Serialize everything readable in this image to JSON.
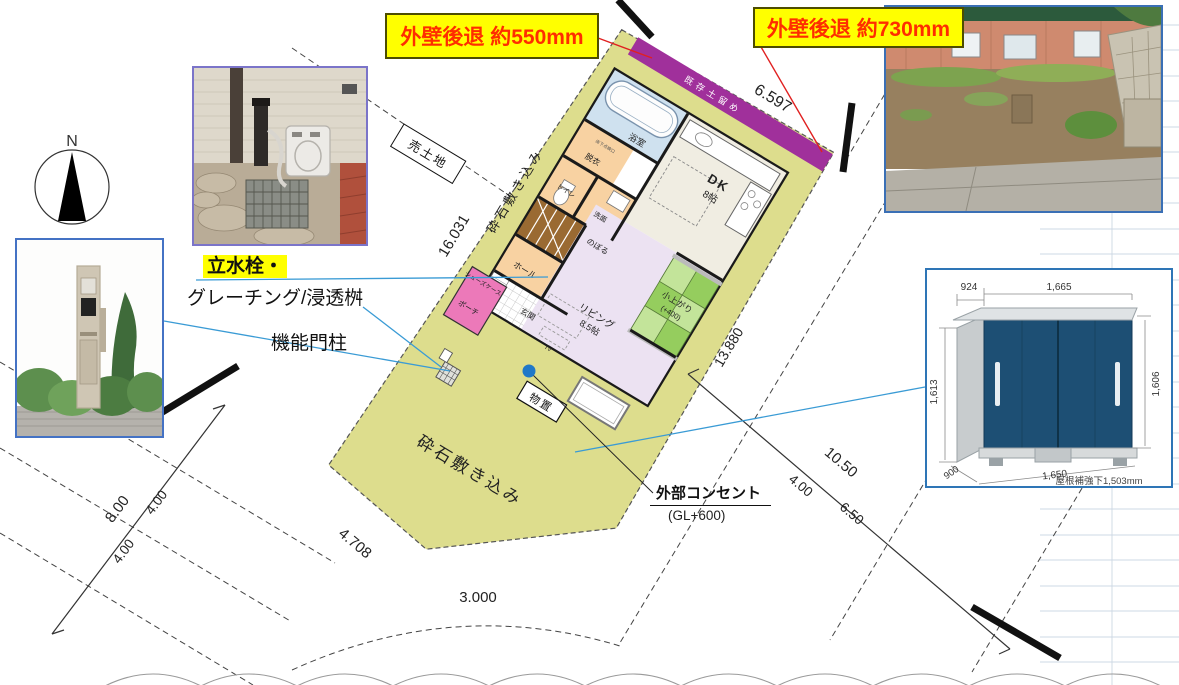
{
  "callouts": {
    "setback_left": "外壁後退 約550mm",
    "setback_right": "外壁後退 約730mm",
    "standpipe": "立水栓・",
    "grating": "グレーチング/浸透桝",
    "gate_post": "機能門柱",
    "outlet": "外部コンセント",
    "outlet_gl": "(GL+600)"
  },
  "site": {
    "for_sale": "売土地",
    "gravel_upper": "砕石敷き込み",
    "gravel_lower": "砕石敷き込み",
    "retaining_wall": "既存土留め",
    "storage": "物置",
    "north": "N"
  },
  "dims": {
    "top": "6.597",
    "left": "16.031",
    "right": "13.880",
    "edge_sw": "4.708",
    "edge_s": "3.000",
    "road_w_total": "8.00",
    "road_w_a": "4.00",
    "road_w_b": "4.00",
    "road_e_total": "10.50",
    "road_e_a": "4.00",
    "road_e_b": "6.50"
  },
  "rooms": {
    "bath": "浴室",
    "dressing": "脱衣",
    "hatch": "床下点検口",
    "toilet": "トイレ",
    "wash": "洗面",
    "stairs_up": "のぼる",
    "hall": "ホール",
    "shoes": "シューズケース",
    "entrance": "玄関",
    "porch": "ポーチ",
    "dk": "DK",
    "dk_size": "8帖",
    "living": "リビング",
    "living_size": "8.5帖",
    "tatami": "小上がり",
    "tatami_h": "(+400)",
    "tv": "TV"
  },
  "shed": {
    "side_w": "924",
    "front_w": "1,665",
    "h_left": "1,613",
    "h_right": "1,606",
    "depth": "900",
    "base_w": "1,650",
    "note": "屋根補強下1,503mm"
  },
  "colors": {
    "site_fill": "#dddd8d",
    "retaining": "#a0309b",
    "porch": "#ec79b9",
    "tatami": "#95cd5e",
    "highlight": "#ffff00",
    "setback_text": "#ff2d00",
    "leader_blue": "#3a9bd5",
    "photo_border": "#4472c4"
  }
}
